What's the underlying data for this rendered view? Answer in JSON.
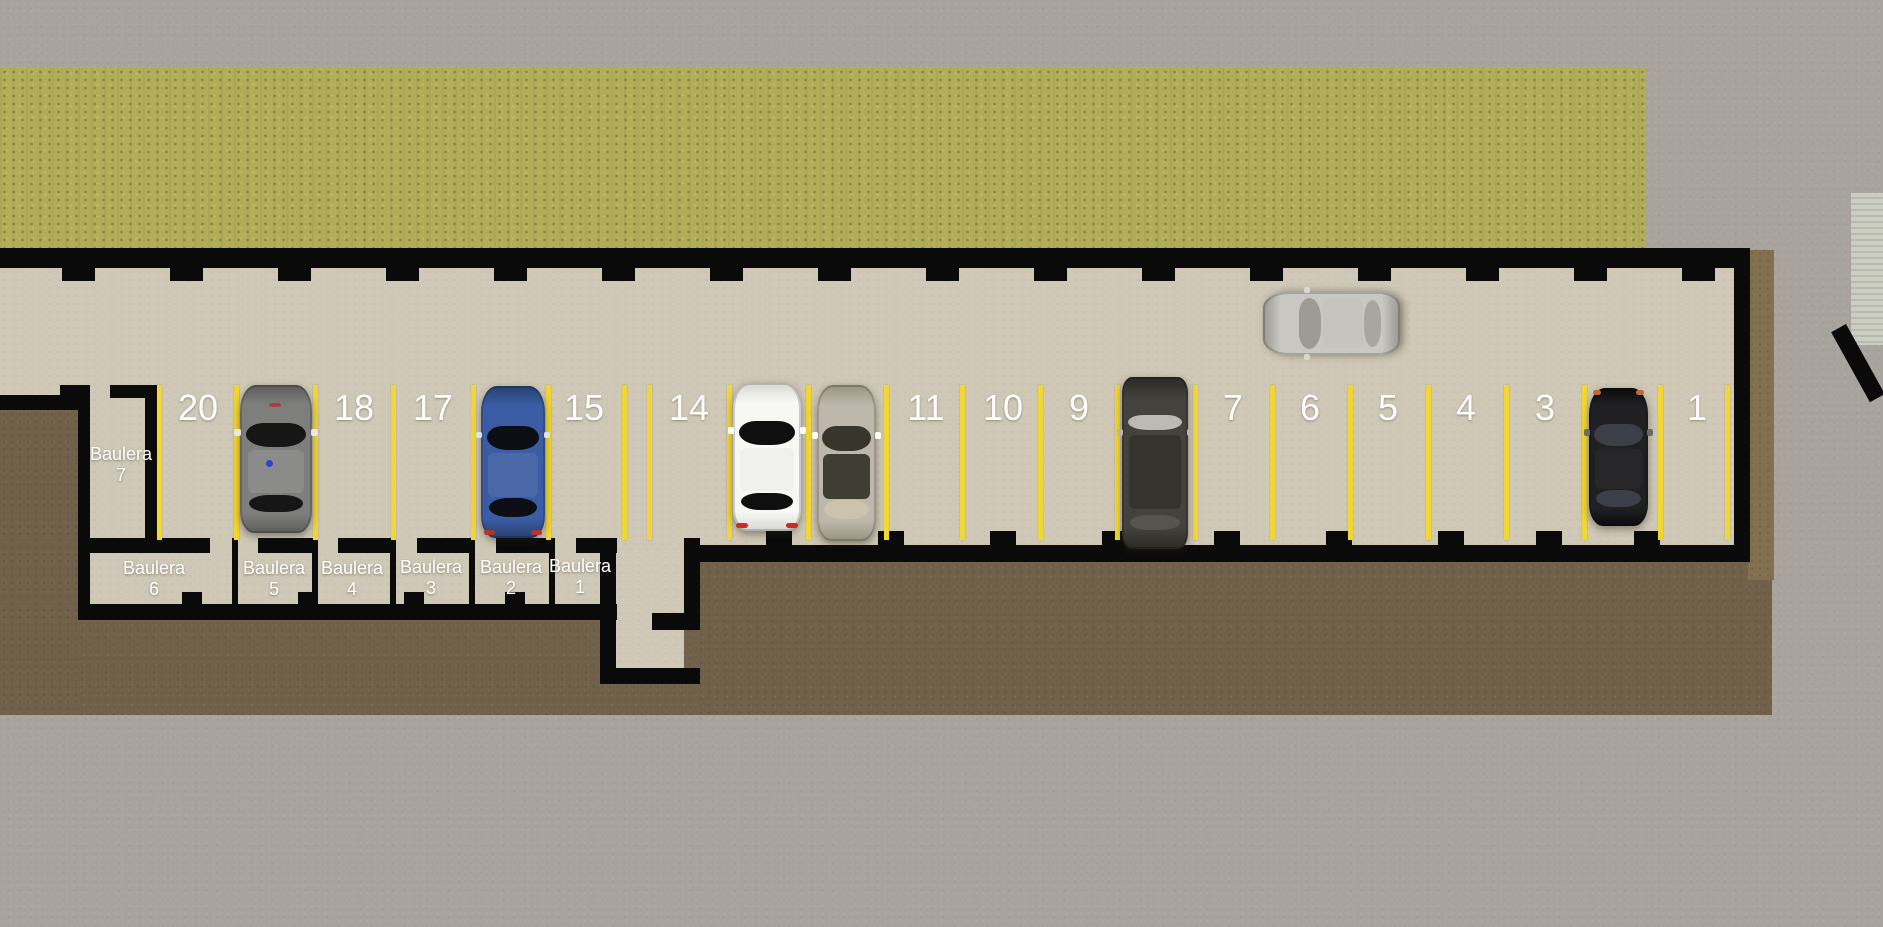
{
  "scene": {
    "title": "Underground parking garage floor plan",
    "width": 1883,
    "height": 927
  },
  "colors": {
    "concrete": "#a8a49d",
    "grass": "#b2ae58",
    "floor": "#cfc8b6",
    "dirt": "#72614a",
    "dirt_right": "#82704f",
    "wall": "#0a0a0a",
    "line_yellow": "#f2d631",
    "label_white": "#ffffff",
    "ramp_base": "#cccec2",
    "ramp_stripe": "#b7bab0"
  },
  "parking_lines": {
    "y": 385,
    "h": 155,
    "w": 5,
    "xs": [
      159,
      236,
      315,
      393,
      473,
      548,
      624,
      649,
      729,
      808,
      886,
      962,
      1040,
      1117,
      1195,
      1272,
      1350,
      1428,
      1506,
      1584,
      1660,
      1727
    ]
  },
  "space_numbers": [
    {
      "label": "20",
      "x": 198
    },
    {
      "label": "18",
      "x": 354
    },
    {
      "label": "17",
      "x": 433
    },
    {
      "label": "15",
      "x": 584
    },
    {
      "label": "14",
      "x": 689
    },
    {
      "label": "11",
      "x": 926
    },
    {
      "label": "10",
      "x": 1003
    },
    {
      "label": "9",
      "x": 1079
    },
    {
      "label": "7",
      "x": 1233
    },
    {
      "label": "6",
      "x": 1310
    },
    {
      "label": "5",
      "x": 1388
    },
    {
      "label": "4",
      "x": 1466
    },
    {
      "label": "3",
      "x": 1545
    },
    {
      "label": "1",
      "x": 1697
    }
  ],
  "baulera_labels": [
    {
      "line1": "Baulera",
      "line2": "7",
      "x": 121,
      "y": 444
    },
    {
      "line1": "Baulera",
      "line2": "6",
      "x": 154,
      "y": 558
    },
    {
      "line1": "Baulera",
      "line2": "5",
      "x": 274,
      "y": 558
    },
    {
      "line1": "Baulera",
      "line2": "4",
      "x": 352,
      "y": 558
    },
    {
      "line1": "Baulera",
      "line2": "3",
      "x": 431,
      "y": 557
    },
    {
      "line1": "Baulera",
      "line2": "2",
      "x": 511,
      "y": 557
    },
    {
      "line1": "Baulera",
      "line2": "1",
      "x": 580,
      "y": 556
    }
  ],
  "pillars": {
    "top": {
      "y": 268,
      "h": 13,
      "w": 33,
      "xs": [
        62,
        170,
        278,
        386,
        494,
        602,
        710,
        818,
        926,
        1034,
        1142,
        1250,
        1358,
        1466,
        1574,
        1682
      ]
    },
    "bottom": {
      "y": 531,
      "h": 14,
      "w": 26,
      "xs": [
        766,
        878,
        990,
        1102,
        1214,
        1326,
        1438,
        1536,
        1634
      ]
    },
    "baulera": {
      "y": 592,
      "h": 13,
      "w": 20,
      "xs": [
        182,
        298,
        404,
        505
      ]
    }
  },
  "cars": [
    {
      "name": "car-space-19-gray",
      "space": "19",
      "style": "",
      "x": 240,
      "y": 385,
      "w": 72,
      "h": 148,
      "rotate": 0,
      "colors": {
        "body": "#7e7e7c",
        "shade": "#5c5c5a",
        "glass": "#161616",
        "roof": "#8b8b89",
        "mirror": "#e8e8e6",
        "dot": "#2b48cc",
        "hood_mark": "#b43a3a"
      }
    },
    {
      "name": "car-space-16-blue",
      "space": "16",
      "style": "",
      "x": 481,
      "y": 386,
      "w": 64,
      "h": 152,
      "rotate": 0,
      "colors": {
        "body": "#3b5ca4",
        "shade": "#27406f",
        "glass": "#0c0e14",
        "roof": "#4a68a8",
        "mirror": "#dfe2e8",
        "tail": "#b8322c"
      }
    },
    {
      "name": "car-space-13-white",
      "space": "13",
      "style": "",
      "x": 733,
      "y": 383,
      "w": 68,
      "h": 148,
      "rotate": 0,
      "colors": {
        "body": "#f7f7f4",
        "shade": "#d7d7d2",
        "glass": "#0f0f0f",
        "roof": "#f0f0ed",
        "mirror": "#ffffff",
        "tail": "#cf2a22"
      }
    },
    {
      "name": "car-space-12-silver",
      "space": "12",
      "style": "",
      "x": 817,
      "y": 385,
      "w": 59,
      "h": 156,
      "rotate": 0,
      "colors": {
        "body": "#bdb8ab",
        "shade": "#989380",
        "glass": "#38352c",
        "roof": "#403d34",
        "rear_glass": "#cbc3ab",
        "mirror": "#ffffff"
      }
    },
    {
      "name": "car-space-8-suv",
      "space": "8",
      "style": "suv",
      "x": 1122,
      "y": 377,
      "w": 66,
      "h": 172,
      "rotate": 0,
      "colors": {
        "body": "#44423c",
        "shade": "#2b2a26",
        "glass": "#bcbab2",
        "roof": "#35332e",
        "rear_glass": "#56544d",
        "mirror": "#b5b3ac"
      }
    },
    {
      "name": "car-space-2-black",
      "space": "2",
      "style": "",
      "x": 1589,
      "y": 388,
      "w": 59,
      "h": 138,
      "rotate": 0,
      "colors": {
        "body": "#202022",
        "shade": "#0c0c0e",
        "glass": "#3a3f48",
        "roof": "#27272a",
        "mirror": "#6a6a68",
        "lamp": "#c06a3a"
      }
    },
    {
      "name": "car-aisle-silver",
      "space": "aisle",
      "style": "",
      "x": 1300,
      "y": 255,
      "w": 63,
      "h": 137,
      "rotate": -90,
      "colors": {
        "body": "#cac8c3",
        "shade": "#98968f",
        "glass": "#9d9b94",
        "roof": "#c6c4be",
        "rear_glass": "#a8a6a0",
        "mirror": "#d8d6d1"
      }
    }
  ]
}
